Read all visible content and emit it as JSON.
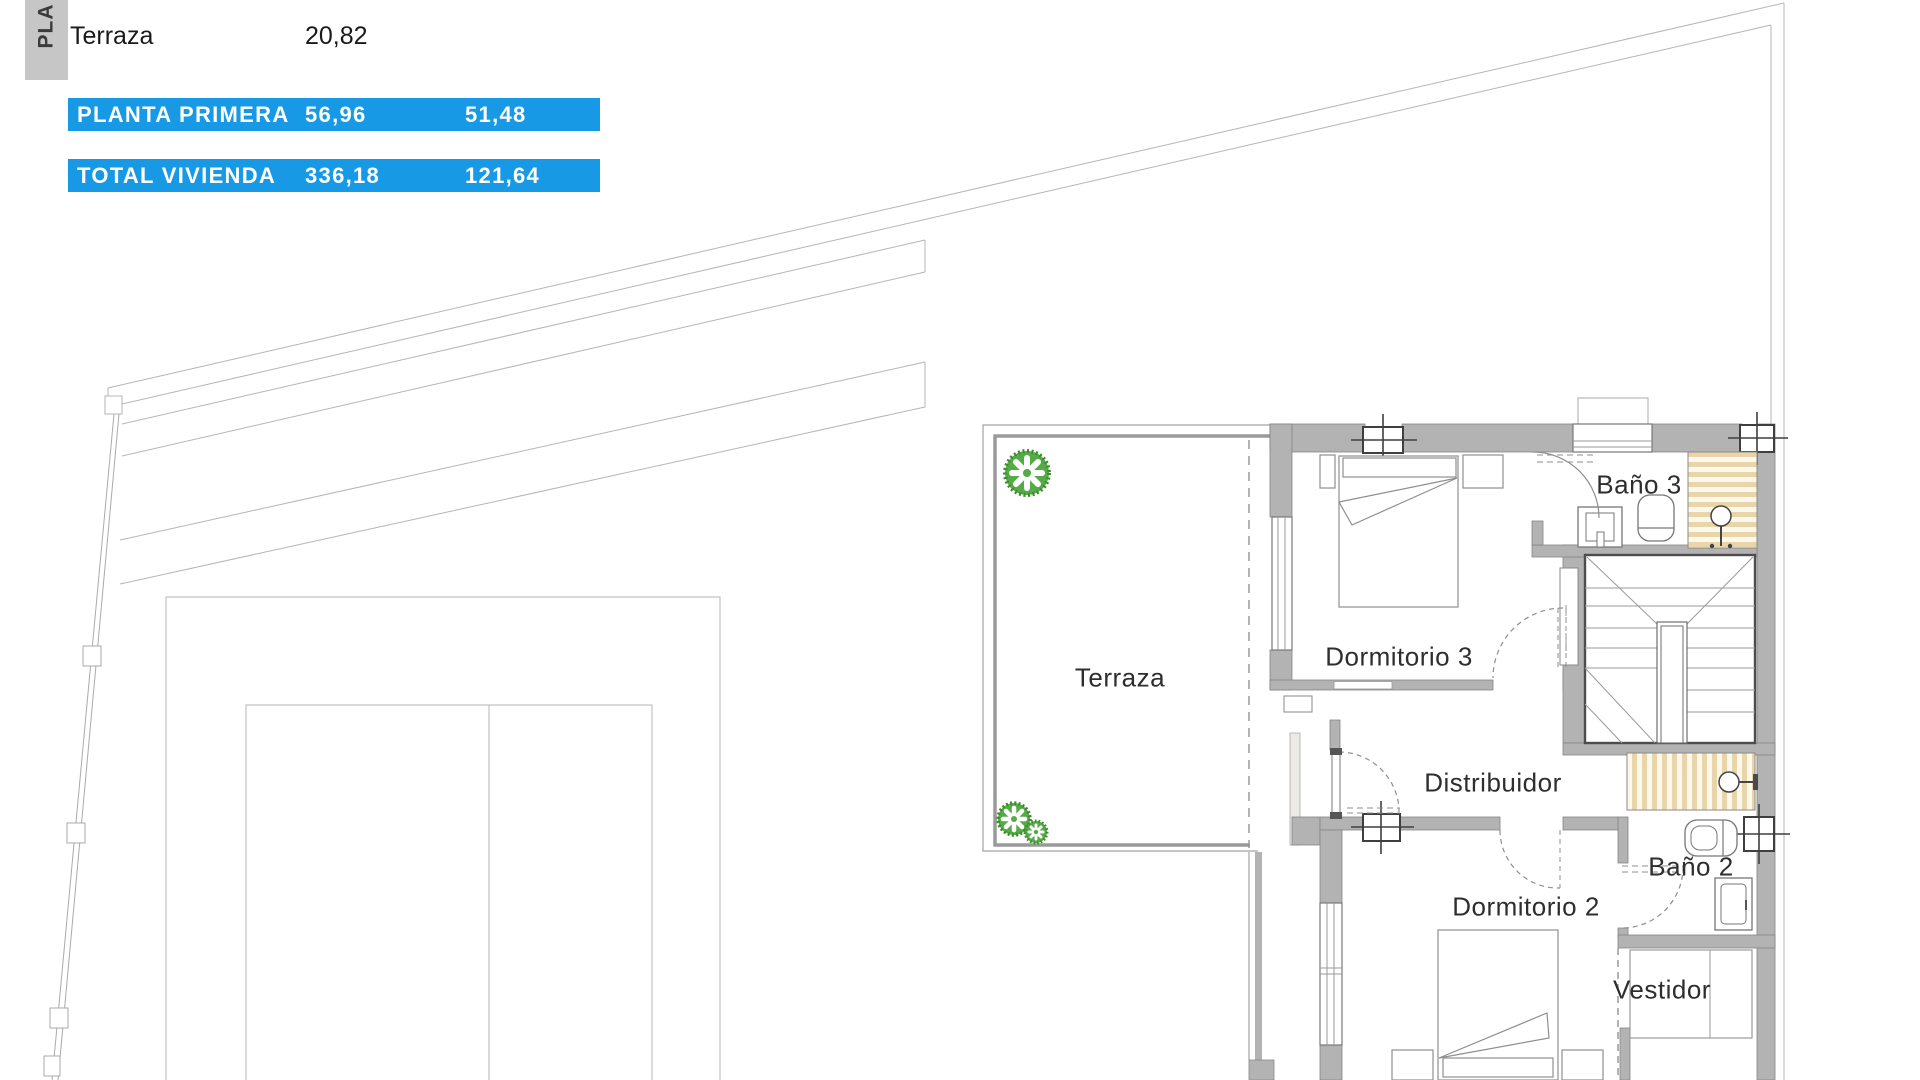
{
  "area_table": {
    "tab_label": "PLA",
    "rows": [
      {
        "label": "Terraza",
        "value1": "20,82",
        "value2": "",
        "highlight": false
      },
      {
        "label": "PLANTA PRIMERA",
        "value1": "56,96",
        "value2": "51,48",
        "highlight": true
      },
      {
        "label": "TOTAL VIVIENDA",
        "value1": "336,18",
        "value2": "121,64",
        "highlight": true
      }
    ]
  },
  "floor_plan": {
    "rooms": [
      {
        "name": "Terraza"
      },
      {
        "name": "Dormitorio 3"
      },
      {
        "name": "Baño 3"
      },
      {
        "name": "Distribuidor"
      },
      {
        "name": "Dormitorio 2"
      },
      {
        "name": "Baño 2"
      },
      {
        "name": "Vestidor"
      }
    ]
  },
  "colors": {
    "accent_blue": "#1899e6",
    "wall_gray": "#b3b3b3",
    "tile_beige": "#e9d5aa",
    "tree_green": "#55ab47"
  }
}
